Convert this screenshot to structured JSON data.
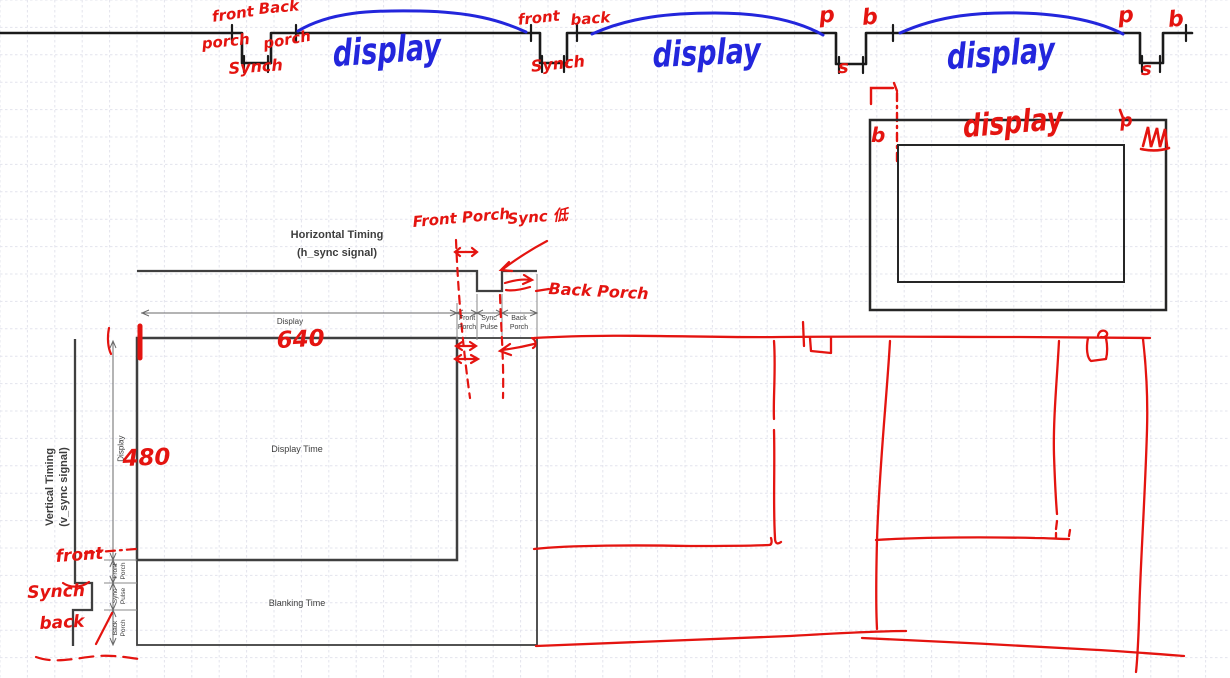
{
  "canvas": {
    "width": 1230,
    "height": 678
  },
  "colors": {
    "ink_red": "#e41410",
    "ink_blue": "#2326dc",
    "ink_black": "#1a1a1a",
    "printed_gray": "#3d3d3d",
    "grid": "#e3e4ed"
  },
  "top_waveform": {
    "pulse1": {
      "front": "front",
      "porch_left": "porch",
      "back": "Back",
      "porch_right": "porch",
      "synch": "Synch"
    },
    "pulse2": {
      "front": "front",
      "back": "back",
      "synch": "Synch"
    },
    "pulse3": {
      "p": "p",
      "b": "b",
      "s": "s"
    },
    "pulse4": {
      "p": "p",
      "b": "b",
      "s": "s"
    },
    "display_arcs": [
      "display",
      "display",
      "display"
    ]
  },
  "screen_sketch": {
    "b": "b",
    "display": "display",
    "p": "p"
  },
  "printed_diagram": {
    "h_title_line1": "Horizontal Timing",
    "h_title_line2": "(h_sync signal)",
    "v_title": "Vertical Timing\n(v_sync signal)",
    "display": "Display",
    "front_porch": "Front\nPorch",
    "sync_pulse": "Sync\nPulse",
    "back_porch": "Back\nPorch",
    "display_time": "Display Time",
    "blanking_time": "Blanking Time"
  },
  "red_annotations": {
    "front_porch": "Front Porch",
    "sync_position": "Sync 低",
    "back_porch": "Back Porch",
    "h_display_value": "640",
    "v_display_value": "480",
    "v_front": "front",
    "v_synch": "Synch",
    "v_back": "back"
  }
}
